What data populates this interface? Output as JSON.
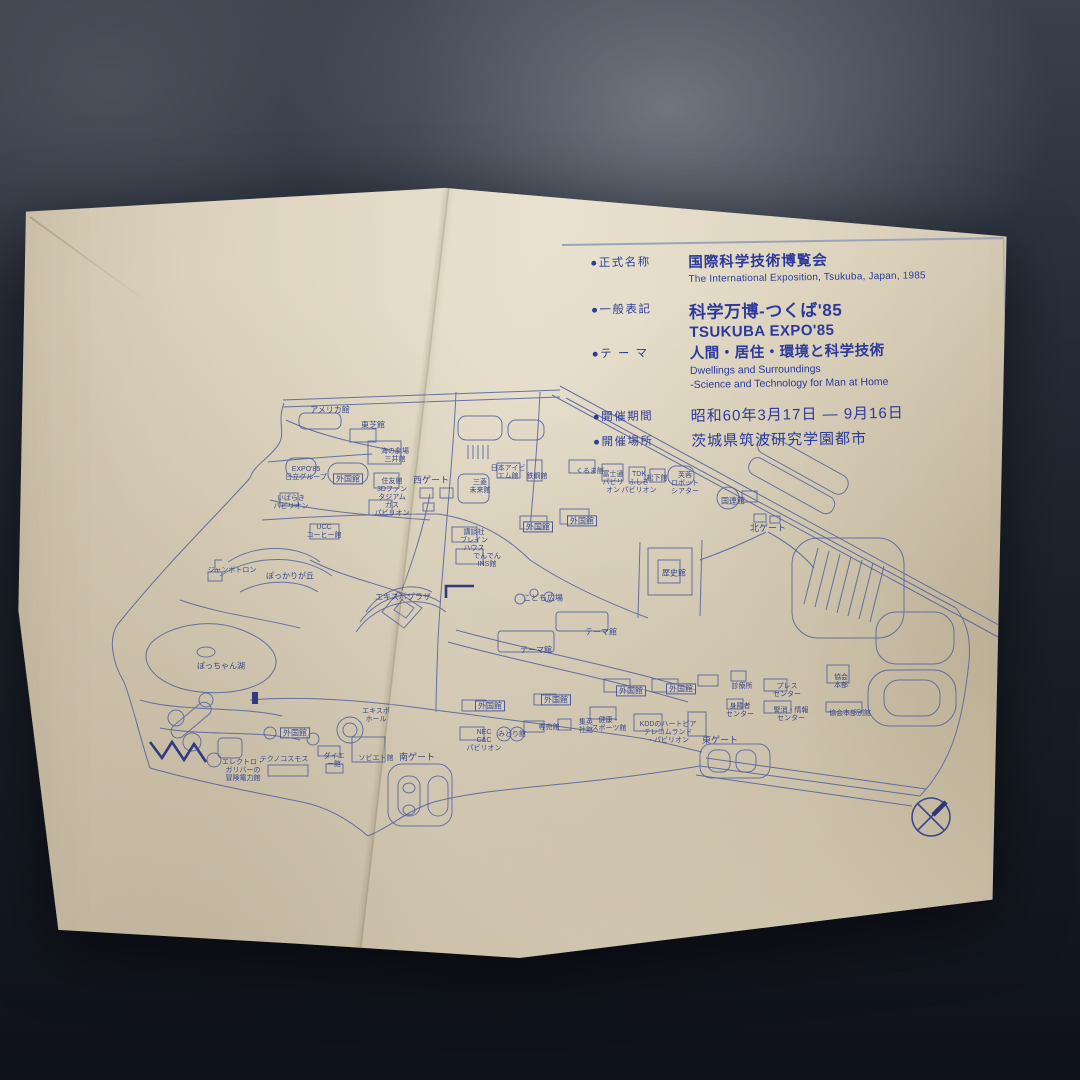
{
  "photo": {
    "background_color": "#1c222e",
    "paper_color": "#d8cdb7",
    "print_color": "#2b3a9b"
  },
  "info_panel": {
    "rows": [
      {
        "label": "●正式名称",
        "ja": "国際科学技術博覧会",
        "en": "The International Exposition, Tsukuba, Japan, 1985"
      },
      {
        "label": "●一般表記",
        "ja": "科学万博-つくば'85",
        "en": "TSUKUBA EXPO'85"
      },
      {
        "label": "●テ ー マ",
        "ja": "人間・居住・環境と科学技術",
        "en": "Dwellings and Surroundings",
        "en2": "-Science and Technology  for Man at Home"
      },
      {
        "label": "●開催期間",
        "ja": "昭和60年3月17日 — 9月16日"
      },
      {
        "label": "●開催場所",
        "ja": "茨城県筑波研究学園都市"
      }
    ]
  },
  "map": {
    "line_color": "#55629f",
    "label_color": "#39478c",
    "labels": [
      {
        "text": "アメリカ館",
        "x": 330,
        "y": 410
      },
      {
        "text": "東芝館",
        "x": 373,
        "y": 425
      },
      {
        "text": "海の劇場\n三井館",
        "x": 395,
        "y": 456,
        "size": 7
      },
      {
        "text": "EXPO'85\n日立グループ",
        "x": 306,
        "y": 474,
        "size": 7
      },
      {
        "text": "外国館",
        "x": 348,
        "y": 479,
        "boxed": true
      },
      {
        "text": "住友館\n3Dファン\nタジアム",
        "x": 392,
        "y": 490,
        "size": 7
      },
      {
        "text": "西ゲート",
        "x": 431,
        "y": 480,
        "size": 9
      },
      {
        "text": "三菱\n未来館",
        "x": 480,
        "y": 487,
        "size": 7
      },
      {
        "text": "日本アイビ\nエム館",
        "x": 508,
        "y": 473,
        "size": 7
      },
      {
        "text": "鉄鋼館",
        "x": 537,
        "y": 477,
        "size": 7
      },
      {
        "text": "くるま館",
        "x": 590,
        "y": 472,
        "size": 7
      },
      {
        "text": "富士通\nパビリ\nオン",
        "x": 613,
        "y": 483,
        "size": 7
      },
      {
        "text": "TDK\nふしぎ\nパビリオン",
        "x": 639,
        "y": 483,
        "size": 7
      },
      {
        "text": "松下館",
        "x": 657,
        "y": 479,
        "size": 7
      },
      {
        "text": "芙蓉\nロボット\nシアター",
        "x": 685,
        "y": 484,
        "size": 7
      },
      {
        "text": "国連館",
        "x": 733,
        "y": 501
      },
      {
        "text": "北ゲート",
        "x": 768,
        "y": 528,
        "size": 9
      },
      {
        "text": "歴史館",
        "x": 674,
        "y": 573
      },
      {
        "text": "外国館",
        "x": 538,
        "y": 527,
        "boxed": true
      },
      {
        "text": "外国館",
        "x": 582,
        "y": 521,
        "boxed": true
      },
      {
        "text": "講談社\nブレイン\nハウス",
        "x": 474,
        "y": 541,
        "size": 7
      },
      {
        "text": "でんでん\nINS館",
        "x": 487,
        "y": 561,
        "size": 7
      },
      {
        "text": "いばらき\nパビリオン",
        "x": 291,
        "y": 503,
        "size": 7
      },
      {
        "text": "UCC\nコーヒー館",
        "x": 324,
        "y": 532,
        "size": 7
      },
      {
        "text": "ガス\nパビリオン",
        "x": 392,
        "y": 510,
        "size": 7
      },
      {
        "text": "ジャンボトロン",
        "x": 232,
        "y": 571,
        "size": 7
      },
      {
        "text": "ぽっかりが丘",
        "x": 290,
        "y": 576
      },
      {
        "text": "エキスポプラザ",
        "x": 403,
        "y": 597
      },
      {
        "text": "ぽっちゃん湖",
        "x": 221,
        "y": 666
      },
      {
        "text": "こども広場",
        "x": 543,
        "y": 598
      },
      {
        "text": "テーマ館",
        "x": 601,
        "y": 632
      },
      {
        "text": "テーマ館",
        "x": 536,
        "y": 650
      },
      {
        "text": "外国館",
        "x": 631,
        "y": 691,
        "boxed": true
      },
      {
        "text": "外国館",
        "x": 681,
        "y": 689,
        "boxed": true
      },
      {
        "text": "外国館",
        "x": 490,
        "y": 706,
        "boxed": true
      },
      {
        "text": "外国館",
        "x": 556,
        "y": 700,
        "boxed": true
      },
      {
        "text": "NEC\nC&C\nパビリオン",
        "x": 484,
        "y": 741,
        "size": 7
      },
      {
        "text": "みどり館",
        "x": 512,
        "y": 735,
        "size": 7
      },
      {
        "text": "専売館",
        "x": 549,
        "y": 728,
        "size": 7
      },
      {
        "text": "集英\n社館",
        "x": 586,
        "y": 727,
        "size": 7
      },
      {
        "text": "健康・\nスポーツ館",
        "x": 609,
        "y": 725,
        "size": 7
      },
      {
        "text": "KDDのハートピア\nテレコムランド\n・パビリオン",
        "x": 668,
        "y": 733,
        "size": 7
      },
      {
        "text": "エキスポ\nホール",
        "x": 376,
        "y": 716,
        "size": 7
      },
      {
        "text": "外国館",
        "x": 295,
        "y": 733,
        "boxed": true
      },
      {
        "text": "南ゲート",
        "x": 417,
        "y": 757,
        "size": 9
      },
      {
        "text": "ソビエト館",
        "x": 376,
        "y": 759,
        "size": 7
      },
      {
        "text": "ダイエ\nー館",
        "x": 334,
        "y": 761,
        "size": 7
      },
      {
        "text": "テクノコスモス",
        "x": 284,
        "y": 760,
        "size": 7
      },
      {
        "text": "エレクトロ・\nガリバーの\n冒険電力館",
        "x": 243,
        "y": 771,
        "size": 7
      },
      {
        "text": "東ゲート",
        "x": 720,
        "y": 740,
        "size": 9
      },
      {
        "text": "診療所",
        "x": 742,
        "y": 687,
        "size": 7
      },
      {
        "text": "プレス\nセンター",
        "x": 787,
        "y": 691,
        "size": 7
      },
      {
        "text": "身障者\nセンター",
        "x": 740,
        "y": 711,
        "size": 7
      },
      {
        "text": "警消・情報\nセンター",
        "x": 791,
        "y": 715,
        "size": 7
      },
      {
        "text": "協会\n本部",
        "x": 841,
        "y": 682,
        "size": 7
      },
      {
        "text": "協会本部別館",
        "x": 850,
        "y": 714,
        "size": 7
      }
    ]
  }
}
